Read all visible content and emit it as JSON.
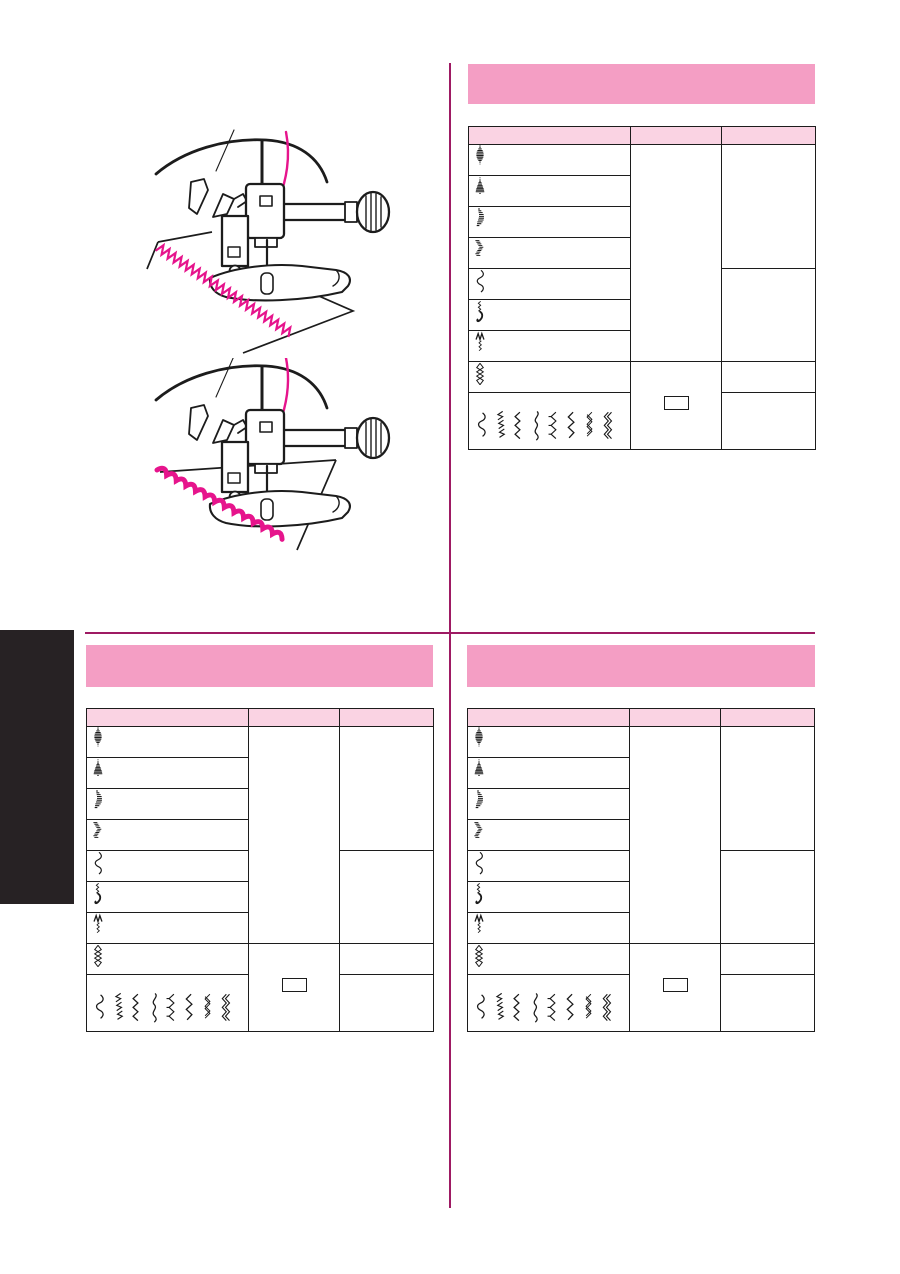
{
  "document": {
    "kind": "sewing-machine-manual-page",
    "visible_text": ""
  },
  "colors": {
    "banner_pink": "#F49EC4",
    "table_header_pink": "#FAD3E3",
    "divider_magenta": "#9E1A63",
    "stitch_magenta": "#E6148C",
    "tab_black": "#272224",
    "line_black": "#1C1C1C"
  },
  "sections": [
    {
      "id": "top-right",
      "banner_text": ""
    },
    {
      "id": "bottom-left",
      "banner_text": ""
    },
    {
      "id": "bottom-right",
      "banner_text": ""
    }
  ],
  "illustrations": [
    {
      "name": "zigzag-stitch-sewing-illustration",
      "stitch_type": "zigzag"
    },
    {
      "name": "scallop-stitch-sewing-illustration",
      "stitch_type": "scallop"
    }
  ],
  "stitch_table": {
    "header_labels": [
      "",
      "",
      ""
    ],
    "rows": [
      {
        "icon": "satin-oval-stitch"
      },
      {
        "icon": "satin-triangle-stitch"
      },
      {
        "icon": "satin-crescent-stitch"
      },
      {
        "icon": "satin-slant-stitch"
      },
      {
        "icon": "scallop-wave-stitch"
      },
      {
        "icon": "shell-tuck-stitch"
      },
      {
        "icon": "smocking-stitch"
      },
      {
        "icon": "diamond-chain-stitch"
      }
    ],
    "pattern_row_icons": [
      "scallop-wave-stitch",
      "feather-stitch",
      "zigzag-stitch",
      "smooth-wave-stitch",
      "overlock-stitch",
      "pointed-wave-stitch",
      "crossed-zigzag-stitch",
      "double-zigzag-stitch"
    ],
    "option_box_icon": "empty-option-box"
  }
}
